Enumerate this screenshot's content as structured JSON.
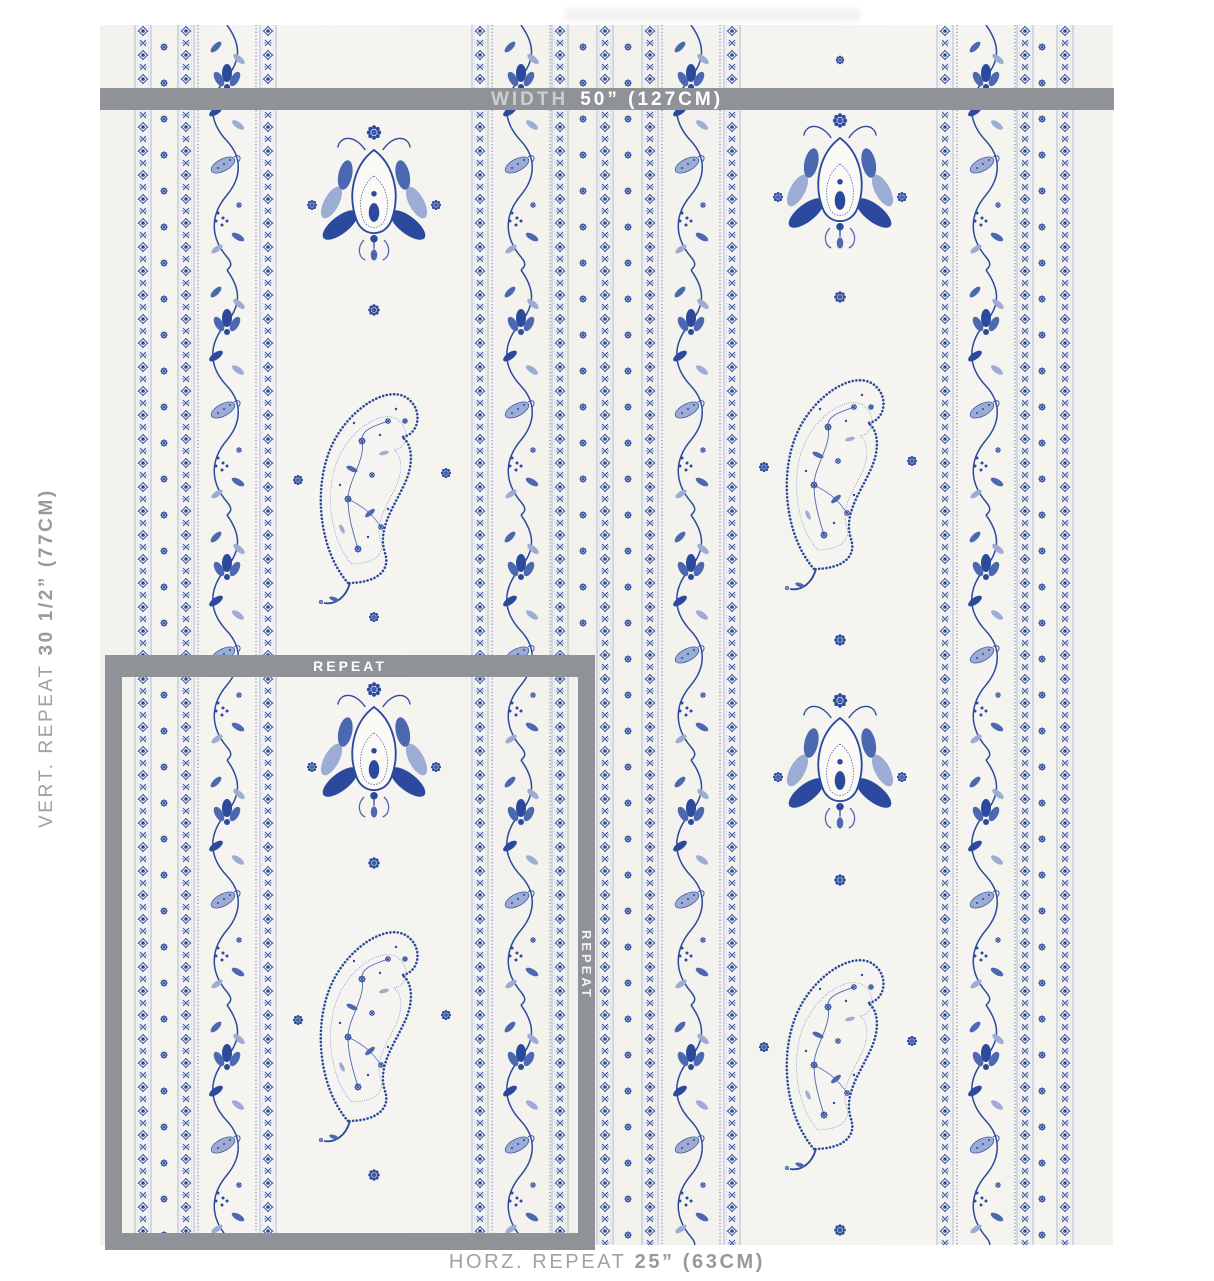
{
  "labels": {
    "width_prefix": "WIDTH",
    "width_value": "50” (127CM)",
    "vert_prefix": "VERT. REPEAT",
    "vert_value": "30 1/2” (77CM)",
    "horz_prefix": "HORZ. REPEAT",
    "horz_value": "25” (63CM)",
    "repeat": "REPEAT",
    "repeat_vertical": "REPEAT"
  },
  "colors": {
    "overlay_gray": "#8f9296",
    "label_gray": "#9fa1a3",
    "bar_text_white": "#ffffff",
    "fabric_bg": "#f5f4f0",
    "blue_dark": "#2c4a9d",
    "blue_mid": "#4c68b0",
    "blue_light": "#9dacd4",
    "motif_ground": "#fbfaf7"
  },
  "fabric": {
    "band_width": 20,
    "vine_width": 62,
    "height": 1220,
    "bands": [
      33,
      76,
      158,
      370,
      450,
      495,
      540,
      622,
      835,
      915,
      955
    ],
    "vines": [
      96,
      390,
      560,
      855
    ],
    "dot_columns": [
      64,
      483,
      528,
      942
    ],
    "dot_spacing": 36,
    "fields": [
      {
        "cx": 274,
        "motifs": [
          {
            "type": "palmette",
            "cy": 180
          },
          {
            "type": "dot",
            "cy": 180,
            "dx": -62,
            "s": 0.7
          },
          {
            "type": "dot",
            "cy": 180,
            "dx": 62,
            "s": 0.7
          },
          {
            "type": "dot",
            "cy": 285,
            "s": 0.8
          },
          {
            "type": "paisley",
            "cy": 462
          },
          {
            "type": "dot",
            "cy": 455,
            "dx": -76,
            "s": 0.7
          },
          {
            "type": "dot",
            "cy": 448,
            "dx": 72,
            "s": 0.7
          },
          {
            "type": "dot",
            "cy": 592,
            "s": 0.7
          },
          {
            "type": "palmette",
            "cy": 737
          },
          {
            "type": "dot",
            "cy": 742,
            "dx": -62,
            "s": 0.7
          },
          {
            "type": "dot",
            "cy": 742,
            "dx": 62,
            "s": 0.7
          },
          {
            "type": "dot",
            "cy": 838,
            "s": 0.8
          },
          {
            "type": "paisley",
            "cy": 1000
          },
          {
            "type": "dot",
            "cy": 995,
            "dx": -76,
            "s": 0.7
          },
          {
            "type": "dot",
            "cy": 990,
            "dx": 72,
            "s": 0.7
          },
          {
            "type": "dot",
            "cy": 1150,
            "s": 0.8
          }
        ]
      },
      {
        "cx": 740,
        "motifs": [
          {
            "type": "dot",
            "cy": 35,
            "s": 0.6
          },
          {
            "type": "palmette",
            "cy": 168
          },
          {
            "type": "dot",
            "cy": 172,
            "dx": -62,
            "s": 0.7
          },
          {
            "type": "dot",
            "cy": 172,
            "dx": 62,
            "s": 0.7
          },
          {
            "type": "dot",
            "cy": 272,
            "s": 0.8
          },
          {
            "type": "paisley",
            "cy": 448
          },
          {
            "type": "dot",
            "cy": 442,
            "dx": -76,
            "s": 0.7
          },
          {
            "type": "dot",
            "cy": 436,
            "dx": 72,
            "s": 0.7
          },
          {
            "type": "dot",
            "cy": 615,
            "s": 0.8
          },
          {
            "type": "palmette",
            "cy": 748
          },
          {
            "type": "dot",
            "cy": 752,
            "dx": -62,
            "s": 0.7
          },
          {
            "type": "dot",
            "cy": 752,
            "dx": 62,
            "s": 0.7
          },
          {
            "type": "dot",
            "cy": 855,
            "s": 0.8
          },
          {
            "type": "paisley",
            "cy": 1028
          },
          {
            "type": "dot",
            "cy": 1022,
            "dx": -76,
            "s": 0.7
          },
          {
            "type": "dot",
            "cy": 1016,
            "dx": 72,
            "s": 0.7
          },
          {
            "type": "dot",
            "cy": 1205,
            "s": 0.8
          }
        ]
      }
    ]
  }
}
